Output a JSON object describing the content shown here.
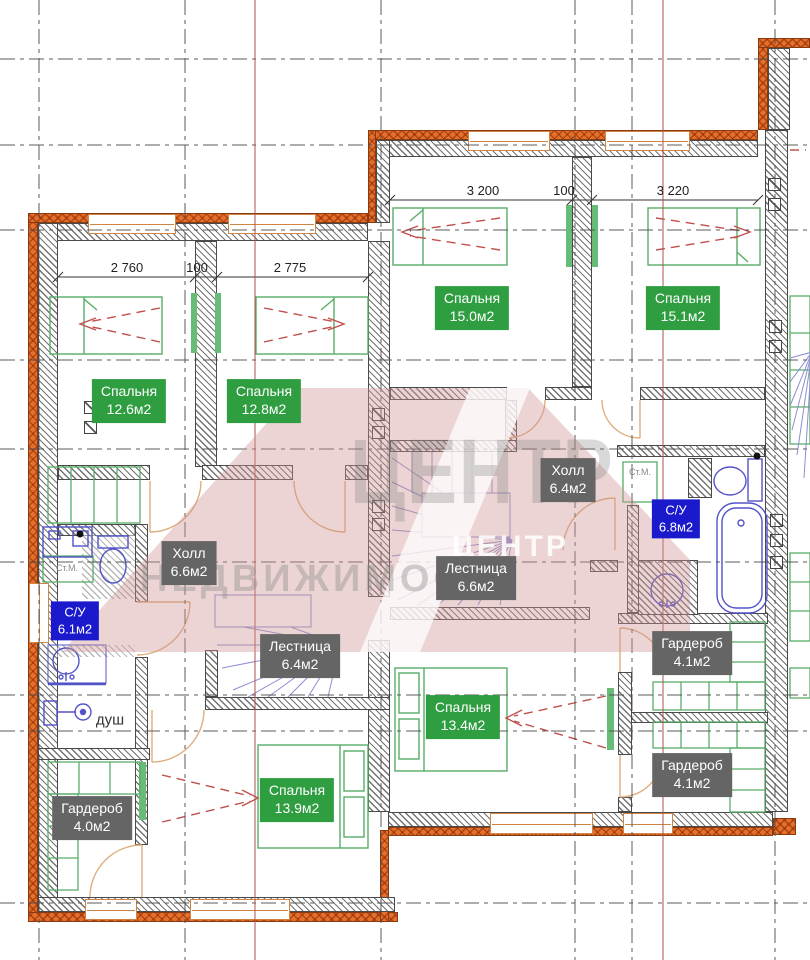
{
  "watermark": {
    "big": "ЦЕНТР",
    "small": "ЦЕНТР",
    "sub": "НЕДВИЖИМОСТИ"
  },
  "dims": {
    "left": [
      "2 760",
      "100",
      "2 775"
    ],
    "right": [
      "3 200",
      "100",
      "3 220"
    ]
  },
  "rooms": [
    {
      "name": "Спальня",
      "area": "12.6м2"
    },
    {
      "name": "Спальня",
      "area": "12.8м2"
    },
    {
      "name": "Спальня",
      "area": "15.0м2"
    },
    {
      "name": "Спальня",
      "area": "15.1м2"
    },
    {
      "name": "Холл",
      "area": "6.6м2"
    },
    {
      "name": "Холл",
      "area": "6.4м2"
    },
    {
      "name": "Лестница",
      "area": "6.4м2"
    },
    {
      "name": "Лестница",
      "area": "6.6м2"
    },
    {
      "name": "С/У",
      "area": "6.1м2"
    },
    {
      "name": "С/У",
      "area": "6.8м2"
    },
    {
      "name": "Гардероб",
      "area": "4.1м2"
    },
    {
      "name": "Гардероб",
      "area": "4.1м2"
    },
    {
      "name": "Гардероб",
      "area": "4.0м2"
    },
    {
      "name": "Спальня",
      "area": "13.9м2"
    },
    {
      "name": "Спальня",
      "area": "13.4м2"
    }
  ],
  "annotations": {
    "shower": "душ",
    "washer": "Ст.М."
  },
  "colors": {
    "wall_orange": "#e4702a",
    "hatch_gray": "#4a4a4a",
    "room_green": "#2f9e41",
    "room_gray": "#656565",
    "room_blue": "#1a1acc",
    "furniture_green": "#58ad68",
    "fixture_blue": "#5353c8",
    "stair_purple": "#8d8dd2",
    "door_tan": "#dfae7d",
    "axis_red": "#b0524c",
    "dash_red": "#c0504d",
    "watermark_pink": "#ce9492"
  }
}
